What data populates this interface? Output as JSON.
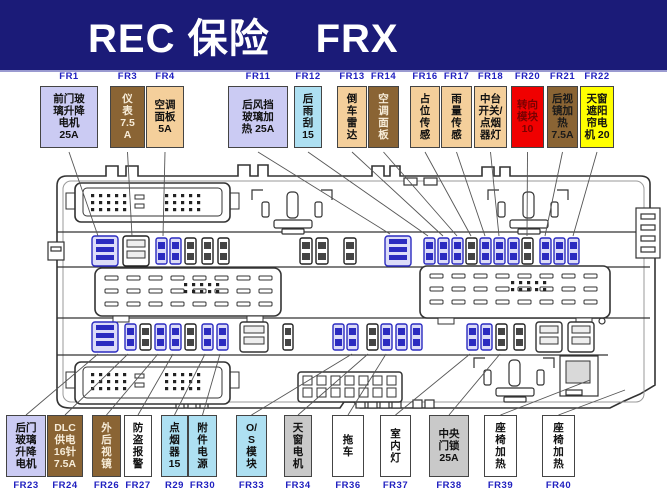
{
  "header": {
    "title_left": "REC 保险",
    "title_right": "FRX",
    "bg": "#1b1b78",
    "text_color": "#ffffff"
  },
  "colors": {
    "lavender": {
      "bg": "#cbcbf3",
      "fg": "#111111"
    },
    "brown": {
      "bg": "#8a6434",
      "fg": "#f7ecd8"
    },
    "brown_dark_text": {
      "bg": "#8a6434",
      "fg": "#1a1a1a"
    },
    "tan": {
      "bg": "#f4cf9b",
      "fg": "#111111"
    },
    "cyan": {
      "bg": "#aee0f2",
      "fg": "#111111"
    },
    "red": {
      "bg": "#f00000",
      "fg": "#7a0000"
    },
    "yellow": {
      "bg": "#ffff00",
      "fg": "#111111"
    },
    "gray": {
      "bg": "#c9c9c9",
      "fg": "#111111"
    },
    "white": {
      "bg": "#ffffff",
      "fg": "#111111"
    },
    "label": "#2020c0",
    "fuse_blue": "#2b2bc0",
    "banner_bg": "#1b1b78"
  },
  "top_row": [
    {
      "id": "FR1",
      "lines": [
        "前门玻",
        "璃升降",
        "电机",
        "25A"
      ],
      "color": "lavender",
      "x": 40,
      "w": 58,
      "target": [
        98,
        236
      ]
    },
    {
      "id": "FR3",
      "lines": [
        "仪",
        "表",
        "7.5",
        "A"
      ],
      "color": "brown",
      "x": 110,
      "w": 35,
      "target": [
        132,
        236
      ]
    },
    {
      "id": "FR4",
      "lines": [
        "空调",
        "面板",
        "5A"
      ],
      "color": "tan",
      "x": 146,
      "w": 38,
      "target": [
        163,
        236
      ]
    },
    {
      "id": "FR11",
      "lines": [
        "后风挡",
        "玻璃加",
        "热 25A"
      ],
      "color": "lavender",
      "x": 228,
      "w": 60,
      "target": [
        390,
        234
      ]
    },
    {
      "id": "FR12",
      "lines": [
        "后",
        "雨",
        "刮",
        "15"
      ],
      "color": "cyan",
      "x": 294,
      "w": 28,
      "target": [
        428,
        236
      ]
    },
    {
      "id": "FR13",
      "lines": [
        "倒",
        "车",
        "雷",
        "达"
      ],
      "color": "tan",
      "x": 337,
      "w": 30,
      "target": [
        443,
        236
      ]
    },
    {
      "id": "FR14",
      "lines": [
        "空",
        "调",
        "面",
        "板"
      ],
      "color": "brown",
      "x": 368,
      "w": 31,
      "target": [
        457,
        236
      ]
    },
    {
      "id": "FR16",
      "lines": [
        "占",
        "位",
        "传",
        "感"
      ],
      "color": "tan",
      "x": 410,
      "w": 30,
      "target": [
        471,
        236
      ]
    },
    {
      "id": "FR17",
      "lines": [
        "雨",
        "量",
        "传",
        "感"
      ],
      "color": "tan",
      "x": 441,
      "w": 31,
      "target": [
        485,
        236
      ]
    },
    {
      "id": "FR18",
      "lines": [
        "中台",
        "开关/",
        "点烟",
        "器灯"
      ],
      "color": "tan",
      "x": 474,
      "w": 33,
      "target": [
        499,
        236
      ]
    },
    {
      "id": "FR20",
      "lines": [
        "转向",
        "模块",
        "10"
      ],
      "color": "red",
      "x": 511,
      "w": 33,
      "target": [
        527,
        236
      ]
    },
    {
      "id": "FR21",
      "lines": [
        "后视",
        "镜加",
        "热",
        "7.5A"
      ],
      "color": "brown_dark_text",
      "x": 547,
      "w": 31,
      "target": [
        545,
        236
      ]
    },
    {
      "id": "FR22",
      "lines": [
        "天窗",
        "遮阳",
        "帘电",
        "机 20"
      ],
      "color": "yellow",
      "x": 580,
      "w": 34,
      "target": [
        573,
        236
      ]
    }
  ],
  "bottom_row": [
    {
      "id": "FR23",
      "lines": [
        "后门",
        "玻璃",
        "升降",
        "电机"
      ],
      "color": "lavender",
      "x": 6,
      "w": 40,
      "target": [
        98,
        354
      ]
    },
    {
      "id": "FR24",
      "lines": [
        "DLC",
        "供电",
        "16针",
        "7.5A"
      ],
      "color": "brown",
      "x": 47,
      "w": 36,
      "target": [
        128,
        354
      ]
    },
    {
      "id": "FR26",
      "lines": [
        "外",
        "后",
        "视",
        "镜"
      ],
      "color": "brown",
      "x": 92,
      "w": 29,
      "target": [
        158,
        354
      ]
    },
    {
      "id": "FR27",
      "lines": [
        "防",
        "盗",
        "报",
        "警"
      ],
      "color": "white",
      "x": 124,
      "w": 28,
      "target": [
        173,
        354
      ]
    },
    {
      "id": "R29",
      "lines": [
        "点",
        "烟",
        "器",
        "15"
      ],
      "color": "cyan",
      "x": 161,
      "w": 27,
      "target": [
        205,
        354
      ]
    },
    {
      "id": "FR30",
      "lines": [
        "附",
        "件",
        "电",
        "源"
      ],
      "color": "cyan",
      "x": 188,
      "w": 29,
      "target": [
        220,
        354
      ]
    },
    {
      "id": "FR33",
      "lines": [
        "O/",
        "S",
        "模",
        "块"
      ],
      "color": "cyan",
      "x": 236,
      "w": 31,
      "target": [
        352,
        354
      ]
    },
    {
      "id": "FR34",
      "lines": [
        "天",
        "窗",
        "电",
        "机"
      ],
      "color": "gray",
      "x": 284,
      "w": 28,
      "target": [
        368,
        354
      ]
    },
    {
      "id": "FR36",
      "lines": [
        "拖",
        "车"
      ],
      "color": "white",
      "x": 332,
      "w": 32,
      "target": [
        386,
        354
      ]
    },
    {
      "id": "FR37",
      "lines": [
        "室",
        "内",
        "灯"
      ],
      "color": "white",
      "x": 380,
      "w": 31,
      "target": [
        470,
        354
      ]
    },
    {
      "id": "FR38",
      "lines": [
        "中央",
        "门锁",
        "25A"
      ],
      "color": "gray",
      "x": 429,
      "w": 40,
      "target": [
        500,
        354
      ]
    },
    {
      "id": "FR39",
      "lines": [
        "座",
        "椅",
        "加",
        "热"
      ],
      "color": "white",
      "x": 484,
      "w": 33,
      "target": [
        590,
        380
      ]
    },
    {
      "id": "FR40",
      "lines": [
        "座",
        "椅",
        "加",
        "热"
      ],
      "color": "white",
      "x": 542,
      "w": 33,
      "target": [
        625,
        390
      ]
    }
  ],
  "diagram": {
    "fuse_rows": [
      {
        "y": 238,
        "items": [
          [
            92,
            26,
            "wblue"
          ],
          [
            123,
            26,
            "wdark"
          ],
          [
            156,
            11,
            "blue"
          ],
          [
            170,
            11,
            "blue"
          ],
          [
            185,
            11,
            "dark"
          ],
          [
            202,
            11,
            "dark"
          ],
          [
            218,
            11,
            "dark"
          ],
          [
            300,
            12,
            "dark"
          ],
          [
            316,
            12,
            "dark"
          ],
          [
            344,
            12,
            "dark"
          ],
          [
            385,
            26,
            "wblue"
          ],
          [
            424,
            11,
            "blue"
          ],
          [
            438,
            11,
            "blue"
          ],
          [
            452,
            11,
            "blue"
          ],
          [
            466,
            11,
            "dark"
          ],
          [
            480,
            11,
            "blue"
          ],
          [
            494,
            11,
            "blue"
          ],
          [
            508,
            11,
            "blue"
          ],
          [
            522,
            11,
            "dark"
          ],
          [
            540,
            11,
            "blue"
          ],
          [
            554,
            11,
            "blue"
          ],
          [
            568,
            11,
            "blue"
          ]
        ]
      },
      {
        "y": 324,
        "items": [
          [
            92,
            26,
            "wblue"
          ],
          [
            125,
            11,
            "blue"
          ],
          [
            140,
            11,
            "dark"
          ],
          [
            155,
            11,
            "blue"
          ],
          [
            170,
            11,
            "blue"
          ],
          [
            185,
            11,
            "dark"
          ],
          [
            202,
            11,
            "blue"
          ],
          [
            217,
            11,
            "blue"
          ],
          [
            240,
            28,
            "wgray"
          ],
          [
            283,
            10,
            "dark"
          ],
          [
            333,
            11,
            "blue"
          ],
          [
            347,
            11,
            "blue"
          ],
          [
            367,
            11,
            "dark"
          ],
          [
            381,
            11,
            "blue"
          ],
          [
            396,
            11,
            "blue"
          ],
          [
            411,
            11,
            "blue"
          ],
          [
            467,
            11,
            "blue"
          ],
          [
            481,
            11,
            "blue"
          ],
          [
            496,
            11,
            "dark"
          ],
          [
            514,
            11,
            "dark"
          ],
          [
            536,
            26,
            "wgray"
          ],
          [
            568,
            26,
            "wgray"
          ]
        ]
      }
    ],
    "pin_connectors": [
      [
        75,
        183,
        155,
        39
      ],
      [
        75,
        362,
        155,
        42
      ]
    ],
    "dash_blocks": [
      [
        95,
        268,
        186,
        48
      ],
      [
        420,
        266,
        190,
        52
      ]
    ],
    "grid_connector": [
      298,
      372,
      104,
      30
    ]
  }
}
